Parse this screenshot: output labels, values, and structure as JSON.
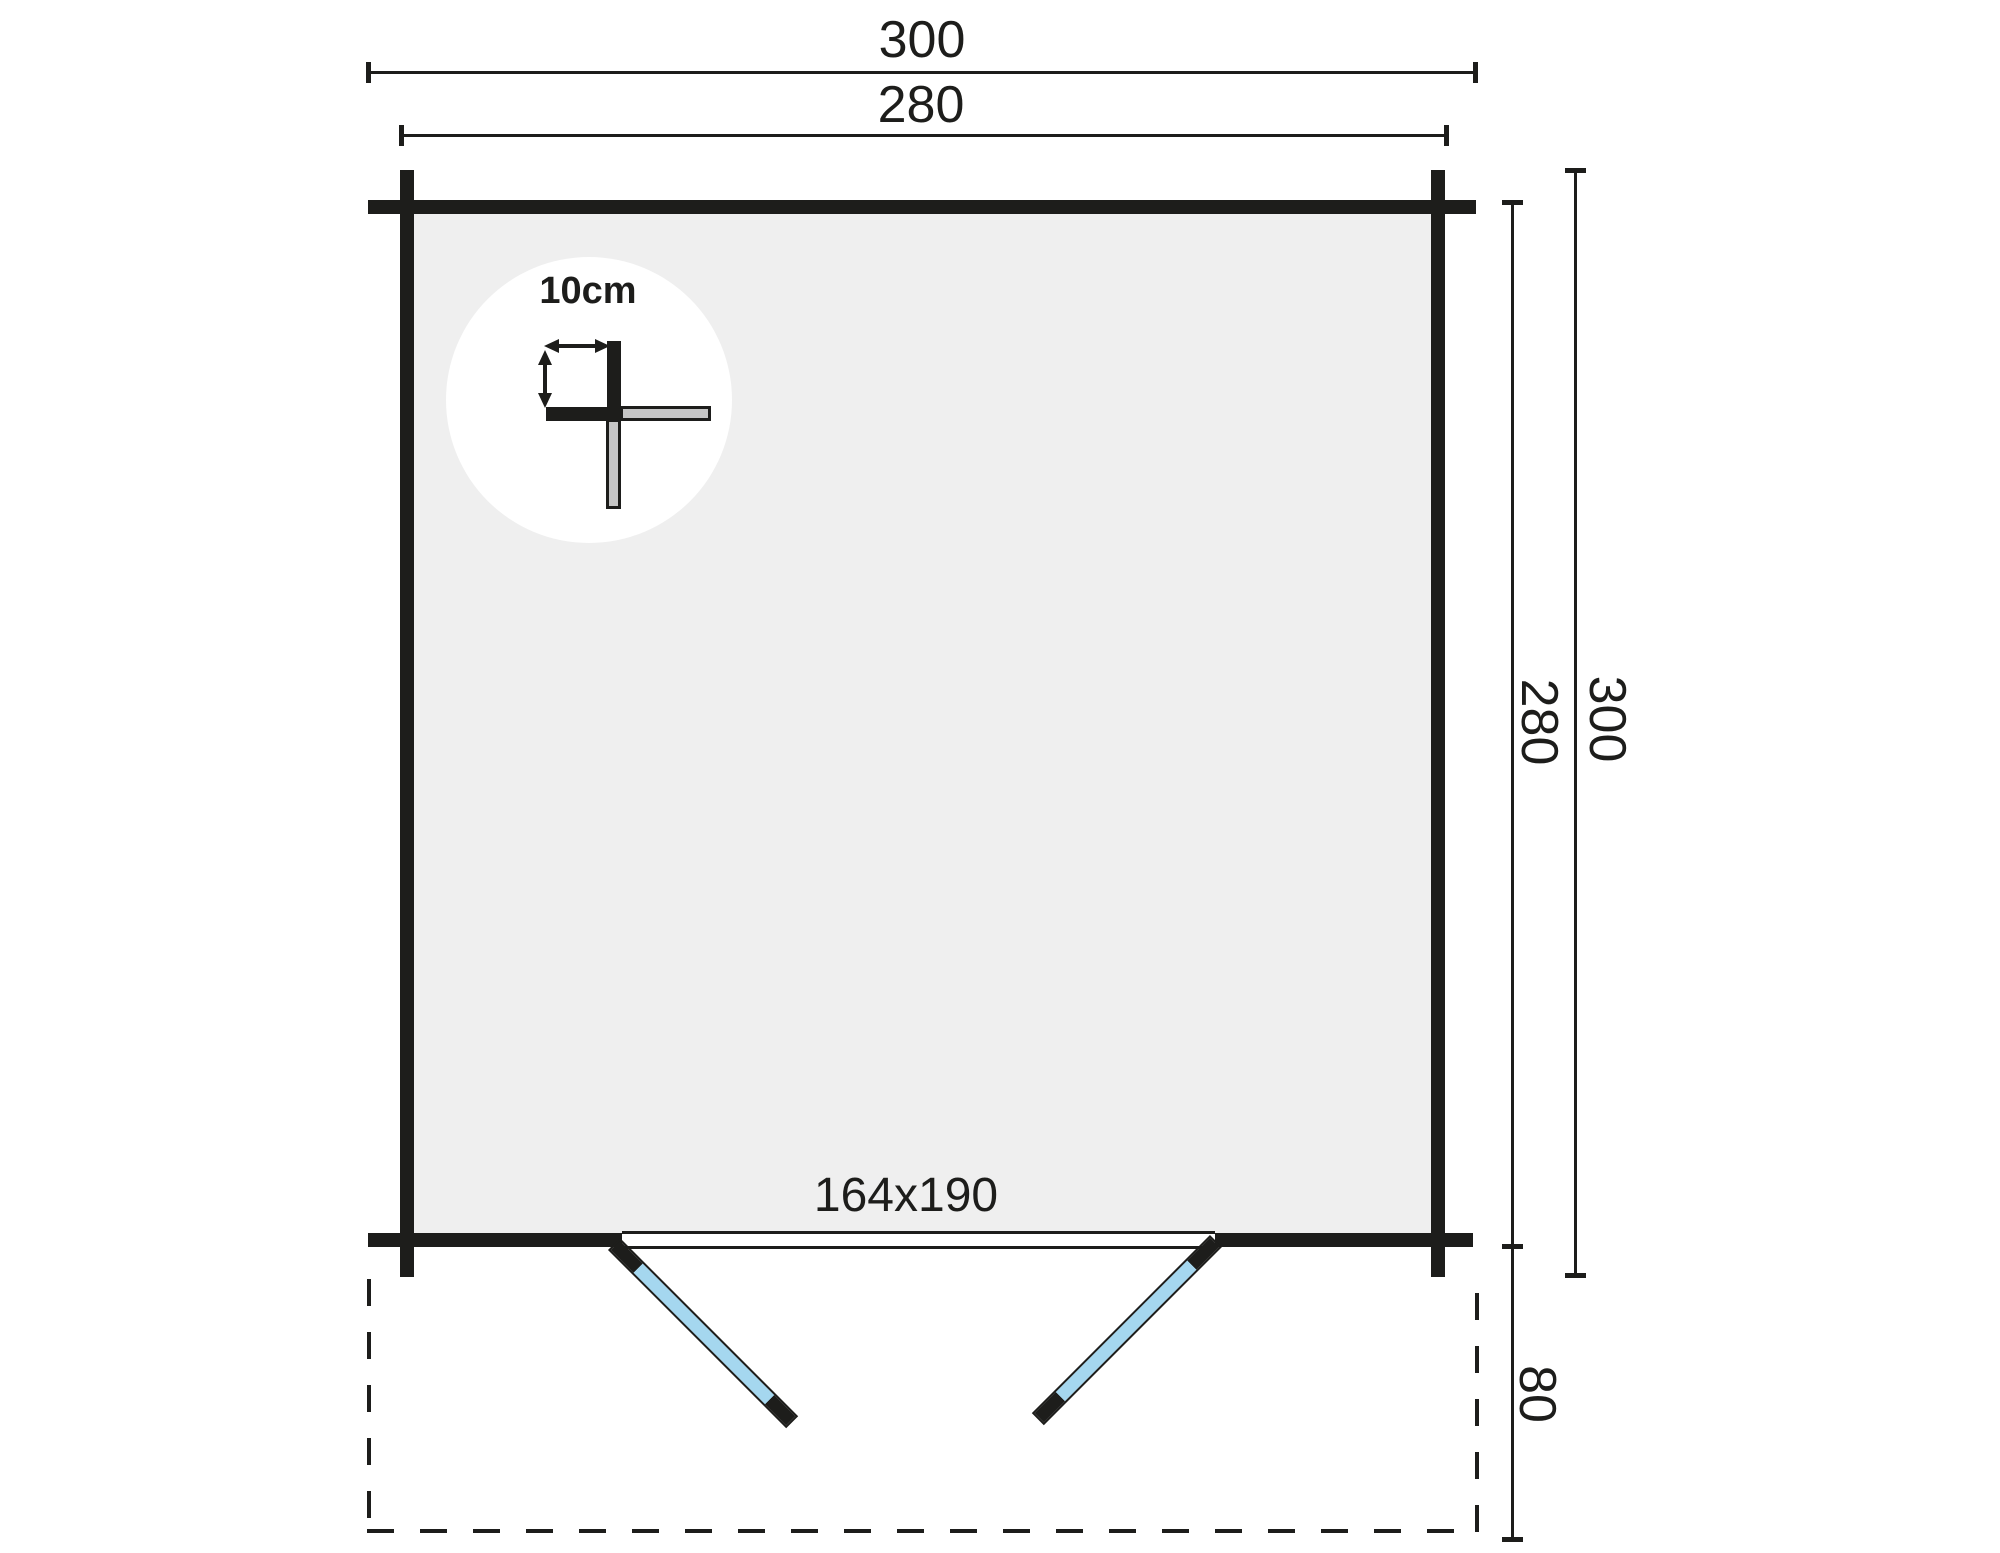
{
  "floor_plan": {
    "type": "log-cabin floor plan",
    "dimensions": {
      "width_overall": "300",
      "width_inner": "280",
      "height_inner": "280",
      "height_overall": "300",
      "porch_depth": "80"
    },
    "door": {
      "size_label": "164x190"
    },
    "wall_detail": {
      "thickness_label": "10cm"
    },
    "colors": {
      "line": "#1d1d1b",
      "floor_fill": "#efefef",
      "door_fill": "#a5d7ef",
      "log_end_fill": "#c6c6c6",
      "background": "#ffffff"
    }
  }
}
